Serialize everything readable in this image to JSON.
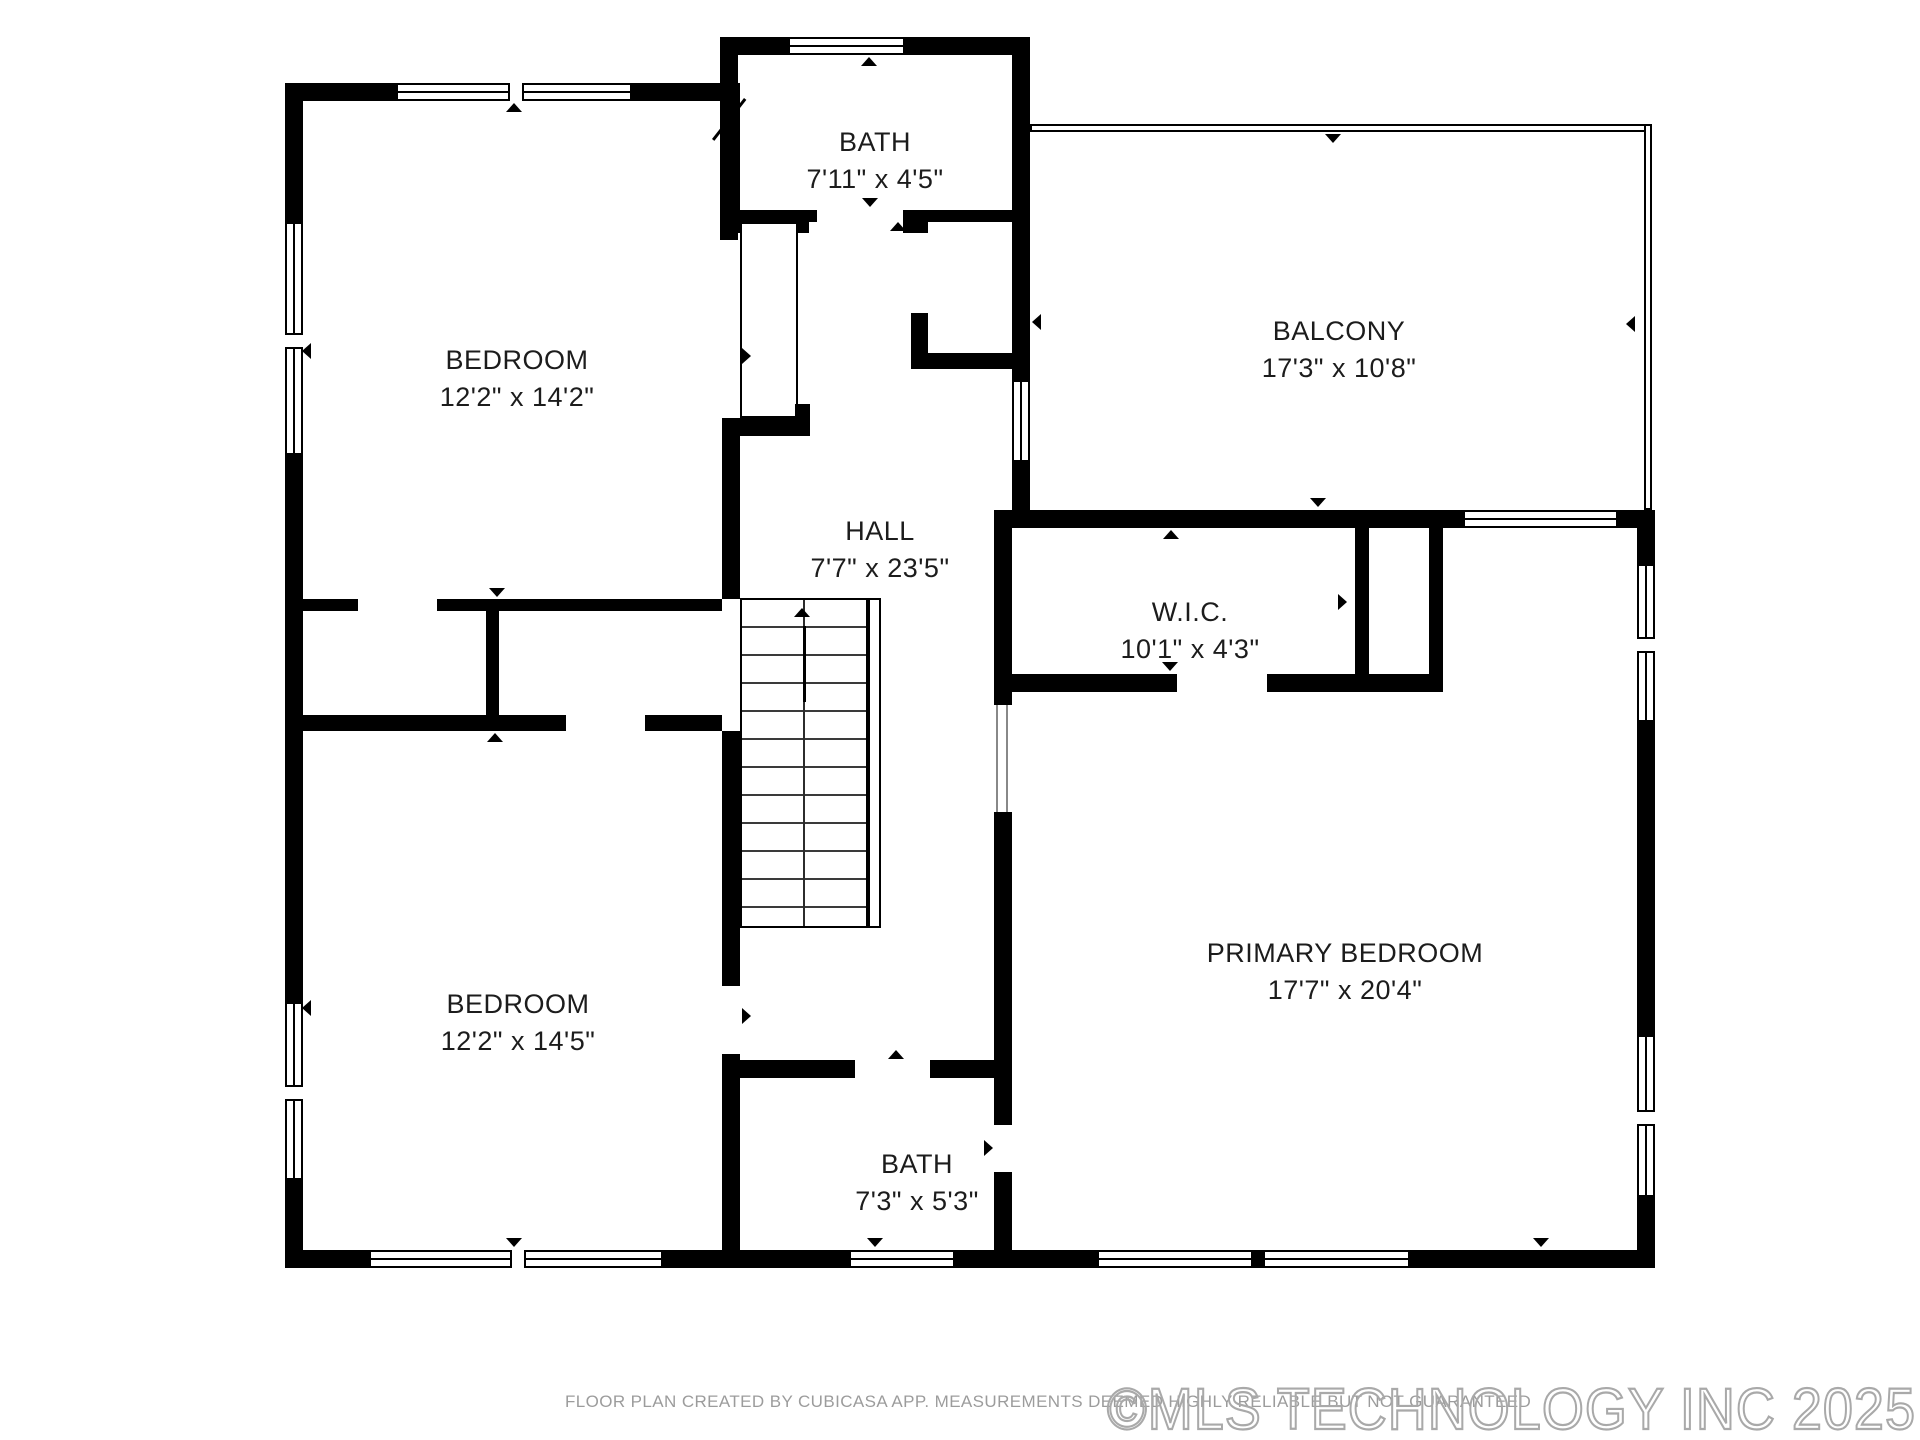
{
  "plan": {
    "rooms": [
      {
        "id": "bath-top",
        "name": "BATH",
        "dims": "7'11\" x 4'5\""
      },
      {
        "id": "bedroom-top",
        "name": "BEDROOM",
        "dims": "12'2\" x 14'2\""
      },
      {
        "id": "balcony",
        "name": "BALCONY",
        "dims": "17'3\" x 10'8\""
      },
      {
        "id": "hall",
        "name": "HALL",
        "dims": "7'7\" x 23'5\""
      },
      {
        "id": "wic",
        "name": "W.I.C.",
        "dims": "10'1\" x 4'3\""
      },
      {
        "id": "bedroom-bottom",
        "name": "BEDROOM",
        "dims": "12'2\" x 14'5\""
      },
      {
        "id": "primary",
        "name": "PRIMARY BEDROOM",
        "dims": "17'7\" x 20'4\""
      },
      {
        "id": "bath-bottom",
        "name": "BATH",
        "dims": "7'3\" x 5'3\""
      }
    ]
  },
  "footer": {
    "disclaimer": "FLOOR PLAN CREATED BY CUBICASA APP. MEASUREMENTS DEEMED HIGHLY RELIABLE BUT NOT GUARANTEED",
    "watermark": "©MLS TECHNOLOGY INC 2025"
  },
  "colors": {
    "wall": "#000000",
    "label": "#1c1c1c",
    "muted_text": "#9c9c9c",
    "watermark_outline": "#a9a9a9"
  }
}
